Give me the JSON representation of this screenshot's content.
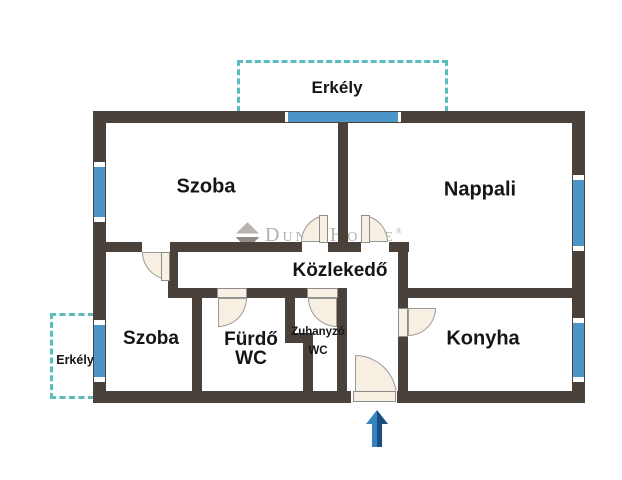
{
  "plan": {
    "type": "apartment-floor-plan",
    "rooms": {
      "szoba_top": "Szoba",
      "nappali": "Nappali",
      "kozlekedo": "Közlekedő",
      "szoba_bottom": "Szoba",
      "furdo_line1": "Fürdő",
      "furdo_line2": "WC",
      "zuhanyzo_line1": "Zuhanyzó",
      "zuhanyzo_line2": "WC",
      "konyha": "Konyha",
      "erkely_top": "Erkély",
      "erkely_left": "Erkély"
    },
    "watermark": {
      "brand": "Duna House",
      "registered": "®"
    },
    "colors": {
      "wall": "#4a423a",
      "window": "#4d95c8",
      "balcony_dash": "#5bbcbd",
      "door_fill": "#f6efe2",
      "door_stroke": "#9a9a9a",
      "label_text": "#151515",
      "watermark_gray": "#b4b0ac",
      "arrow_blue_light": "#3482c0",
      "arrow_blue_dark": "#1b4d80",
      "background": "#ffffff"
    }
  }
}
